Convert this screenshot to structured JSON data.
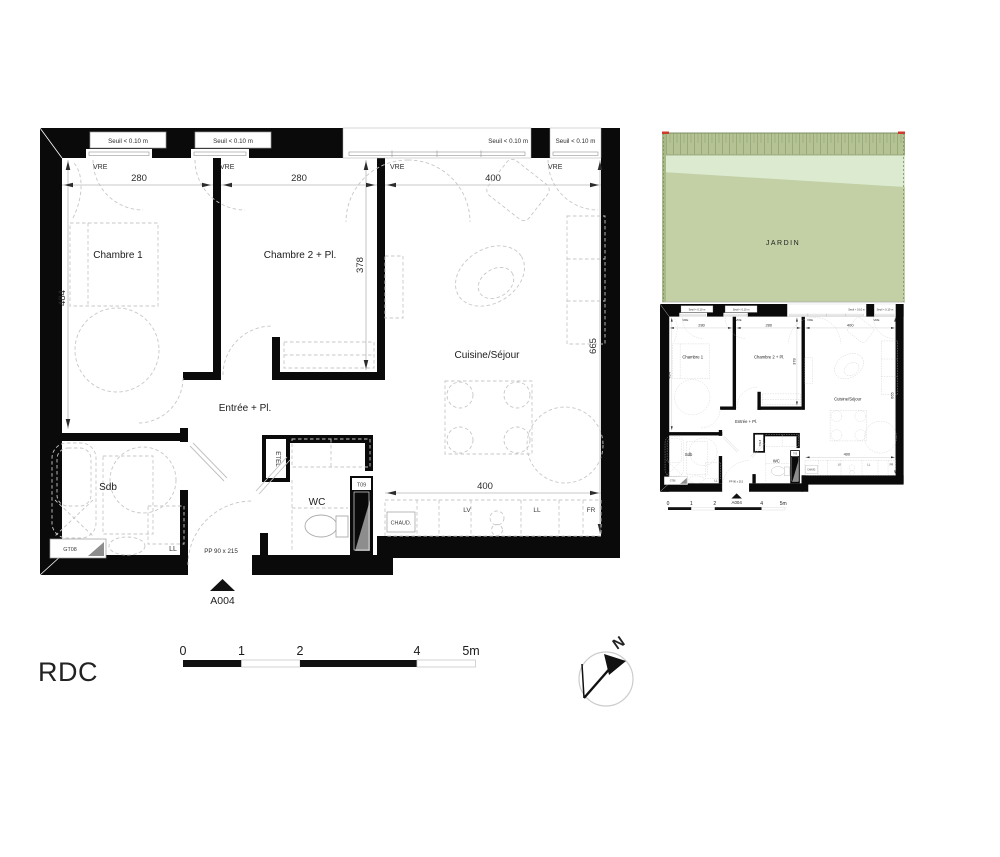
{
  "floor_label": "RDC",
  "north_label": "N",
  "plan": {
    "rooms": {
      "chambre1": "Chambre 1",
      "chambre2": "Chambre 2 + Pl.",
      "cuisine": "Cuisine/Séjour",
      "entree": "Entrée + Pl.",
      "sdb": "Sdb",
      "wc": "WC"
    },
    "dims": {
      "ch1_width": "280",
      "ch2_width": "280",
      "cuisine_width": "400",
      "ch1_depth": "484",
      "ch2_depth": "378",
      "right_depth": "665",
      "kitchen_width": "400"
    },
    "window_threshold": "Seuil < 0.10 m",
    "window_type": "VRE",
    "equipment": {
      "etel": "ETEL",
      "chaud": "CHAUD.",
      "lv": "LV",
      "ll": "LL",
      "fr": "FR",
      "ll_sdb": "LL",
      "gt08": "GT08",
      "t09": "T09"
    },
    "door_spec": "PP 90 x 215",
    "unit_ref": "A004"
  },
  "site": {
    "garden_label": "JARDIN"
  },
  "colors": {
    "garden": "#c3d0a5",
    "garden_light": "#dcead0",
    "hedge": "#b4c294",
    "hedge_line": "#8fa273",
    "accent_red": "#cf3a2e"
  },
  "scalebar": {
    "ticks": [
      "0",
      "1",
      "2",
      "4",
      "5m"
    ]
  }
}
